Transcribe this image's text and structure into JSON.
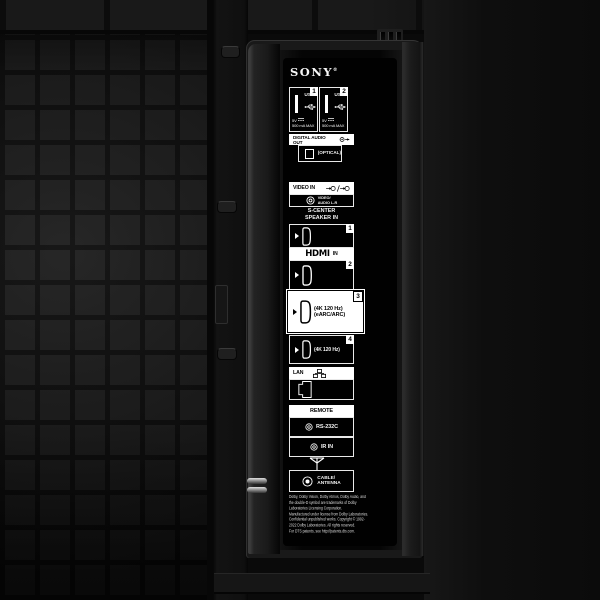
{
  "brand": {
    "name": "SONY",
    "reg": "®"
  },
  "panel": {
    "usb": {
      "ports": [
        {
          "badge": "1",
          "label": "USB",
          "voltage": "5V",
          "current": "500 mA MAX"
        },
        {
          "badge": "2",
          "label": "USB",
          "voltage": "5V",
          "current": "500 mA MAX"
        }
      ]
    },
    "digital_audio_out": {
      "title": "DIGITAL AUDIO OUT",
      "port_label": "(OPTICAL)"
    },
    "video_in": {
      "title": "VIDEO IN",
      "jack_label": "VIDEO/\nAUDIO L-R",
      "note": "S-CENTER\nSPEAKER IN"
    },
    "hdmi": {
      "banner": {
        "logo": "HDMI",
        "suffix": "IN"
      },
      "ports": [
        {
          "badge": "1",
          "label": ""
        },
        {
          "badge": "2",
          "label": ""
        },
        {
          "badge": "3",
          "label": "(4K 120 Hz)\n(eARC/ARC)"
        },
        {
          "badge": "4",
          "label": "(4K 120 Hz)"
        }
      ]
    },
    "lan": {
      "title": "LAN"
    },
    "remote": {
      "title": "REMOTE",
      "jacks": [
        {
          "label": "RS-232C"
        },
        {
          "label": "IR IN"
        }
      ]
    },
    "antenna": {
      "label": "CABLE/\nANTENNA"
    },
    "legal": {
      "text": "Dolby, Dolby Vision, Dolby Atmos, Dolby Audio, and\nthe double-D symbol are trademarks of Dolby\nLaboratories Licensing Corporation.\nManufactured under license from Dolby Laboratories.\nConfidential unpublished works. Copyright © 1992-\n2022 Dolby Laboratories. All rights reserved.\nFor DTS patents, see http://patents.dts.com."
    }
  },
  "colors": {
    "panel_bg": "#000000",
    "line": "#e8e8e8",
    "highlight_bg": "#ffffff",
    "back_plate": "#1b1b1b"
  }
}
